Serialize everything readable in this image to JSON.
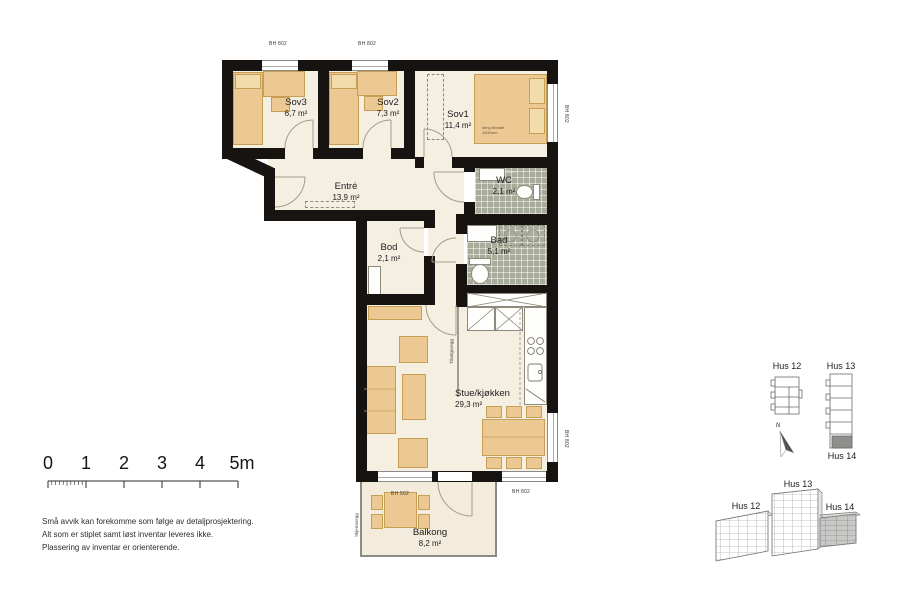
{
  "plan": {
    "rooms": [
      {
        "name": "Sov3",
        "area": "6,7 m²"
      },
      {
        "name": "Sov2",
        "area": "7,3 m²"
      },
      {
        "name": "Sov1",
        "area": "11,4 m²"
      },
      {
        "name": "Entré",
        "area": "13,9 m²"
      },
      {
        "name": "WC",
        "area": "2,1 m²"
      },
      {
        "name": "Bad",
        "area": "5,1 m²"
      },
      {
        "name": "Bod",
        "area": "2,1 m²"
      },
      {
        "name": "Stue/kjøkken",
        "area": "29,3 m²"
      },
      {
        "name": "Balkong",
        "area": "8,2 m²"
      }
    ],
    "notes": {
      "bh802": "BH 802",
      "bh502": "BH 502",
      "bed_line1": "seng bredde",
      "bed_line2": "1600mm",
      "wc_note": "50cm",
      "optional_wall": "Tilvalgsvegg",
      "screen_wall": "Skjermvegg"
    }
  },
  "scale_bar": {
    "labels": [
      "0",
      "1",
      "2",
      "3",
      "4",
      "5m"
    ]
  },
  "disclaimer": {
    "lines": [
      "Små avvik kan forekomme som følge av detaljprosjektering.",
      "Alt som er stiplet samt løst inventar leveres ikke.",
      "Plassering av inventar er orienterende."
    ]
  },
  "site_plan": {
    "hus12": "Hus 12",
    "hus13": "Hus 13",
    "hus14": "Hus 14",
    "north": "N"
  },
  "iso": {
    "hus12": "Hus 12",
    "hus13": "Hus 13",
    "hus14": "Hus 14"
  }
}
